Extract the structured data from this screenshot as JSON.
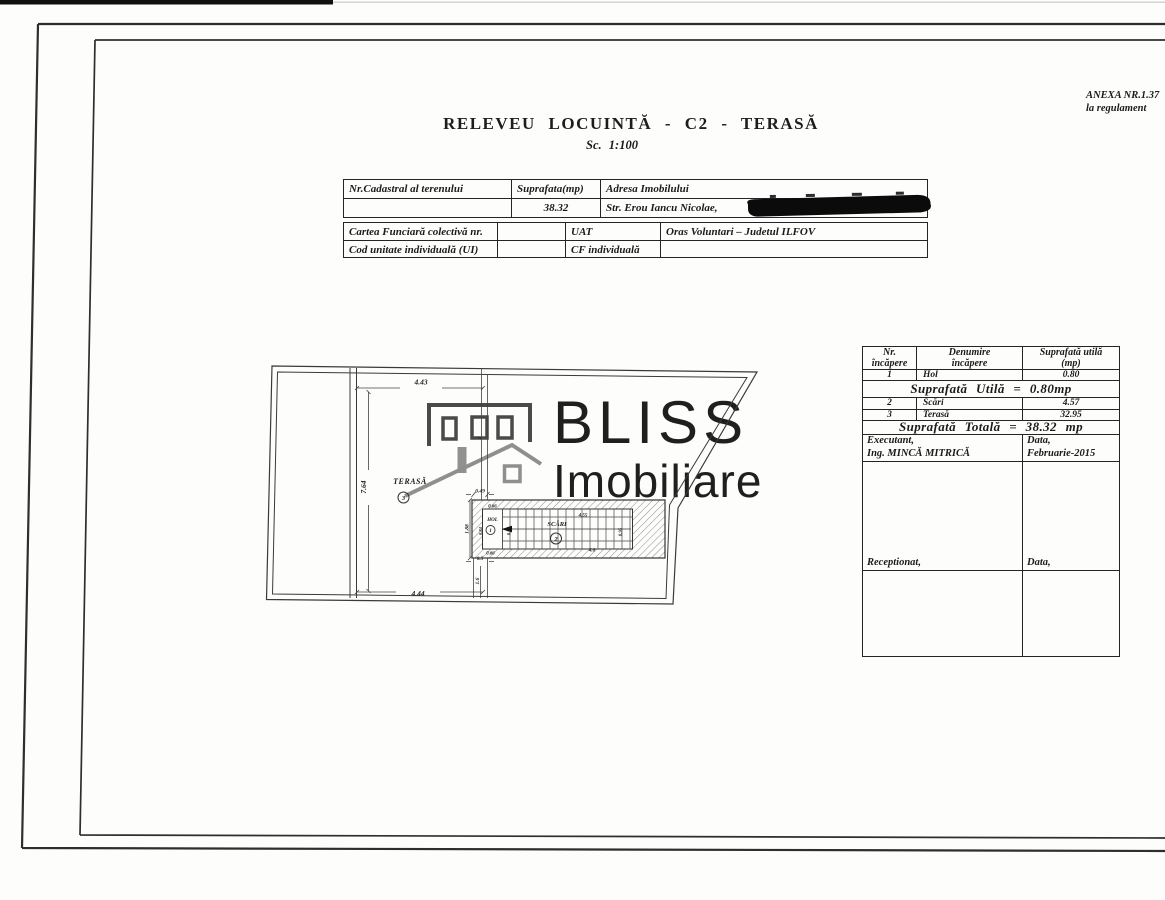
{
  "header": {
    "anexa_line1": "ANEXA NR.1.37",
    "anexa_line2": "la regulament",
    "title": "RELEVEU LOCUINTĂ - C2 - TERASĂ",
    "scale": "Sc. 1:100"
  },
  "cadastral_table": {
    "nr_cadastral_label": "Nr.Cadastral al terenului",
    "suprafata_label": "Suprafata(mp)",
    "adresa_label": "Adresa Imobilului",
    "suprafata_value": "38.32",
    "adresa_value": "Str. Erou Iancu Nicolae,"
  },
  "cf_table": {
    "cartea_funciara_label": "Cartea Funciară colectivă nr.",
    "uat_label": "UAT",
    "uat_value": "Oras Voluntari – Judetul ILFOV",
    "cod_unitate_label": "Cod unitate individuală (UI)",
    "cf_individuala_label": "CF individuală"
  },
  "rooms_table": {
    "header_nr_l1": "Nr.",
    "header_nr_l2": "încăpere",
    "header_den_l1": "Denumire",
    "header_den_l2": "încăpere",
    "header_sup_l1": "Suprafată utilă",
    "header_sup_l2": "(mp)",
    "rows": [
      {
        "nr": "1",
        "name": "Hol",
        "area": "0.80"
      },
      {
        "nr": "2",
        "name": "Scări",
        "area": "4.57"
      },
      {
        "nr": "3",
        "name": "Terasă",
        "area": "32.95"
      }
    ],
    "subtotal": "Suprafată Utilă = 0.80mp",
    "total": "Suprafată Totală = 38.32 mp",
    "executant_label": "Executant,",
    "executant_name": "Ing. MINCĂ MITRICĂ",
    "executant_data_label": "Data,",
    "executant_data_value": "Februarie-2015",
    "receptionat_label": "Receptionat,",
    "receptionat_data_label": "Data,"
  },
  "plan": {
    "room_terasa": "TERASĂ",
    "room_terasa_nr": "3",
    "room_hol": "HOL",
    "room_hol_nr": "1",
    "room_scari": "SCĂRI",
    "room_scari_nr": "2",
    "dims": {
      "top": "4.43",
      "left": "7.64",
      "bottom": "4.44",
      "gap": "2",
      "stair_offset": "0.49",
      "stair_height": "1.88",
      "below_gap": "0.5",
      "below_height": "1.6",
      "hol_top": "0.66",
      "hol_bottom": "0.66",
      "hol_left": "0.84",
      "hol_depth": "0.95",
      "stairs_len_top": "4.55",
      "stairs_len_bottom": "4.6",
      "stairs_width": "0.95"
    }
  },
  "watermark": {
    "line1": "BLISS",
    "line2": "Imobiliare"
  }
}
